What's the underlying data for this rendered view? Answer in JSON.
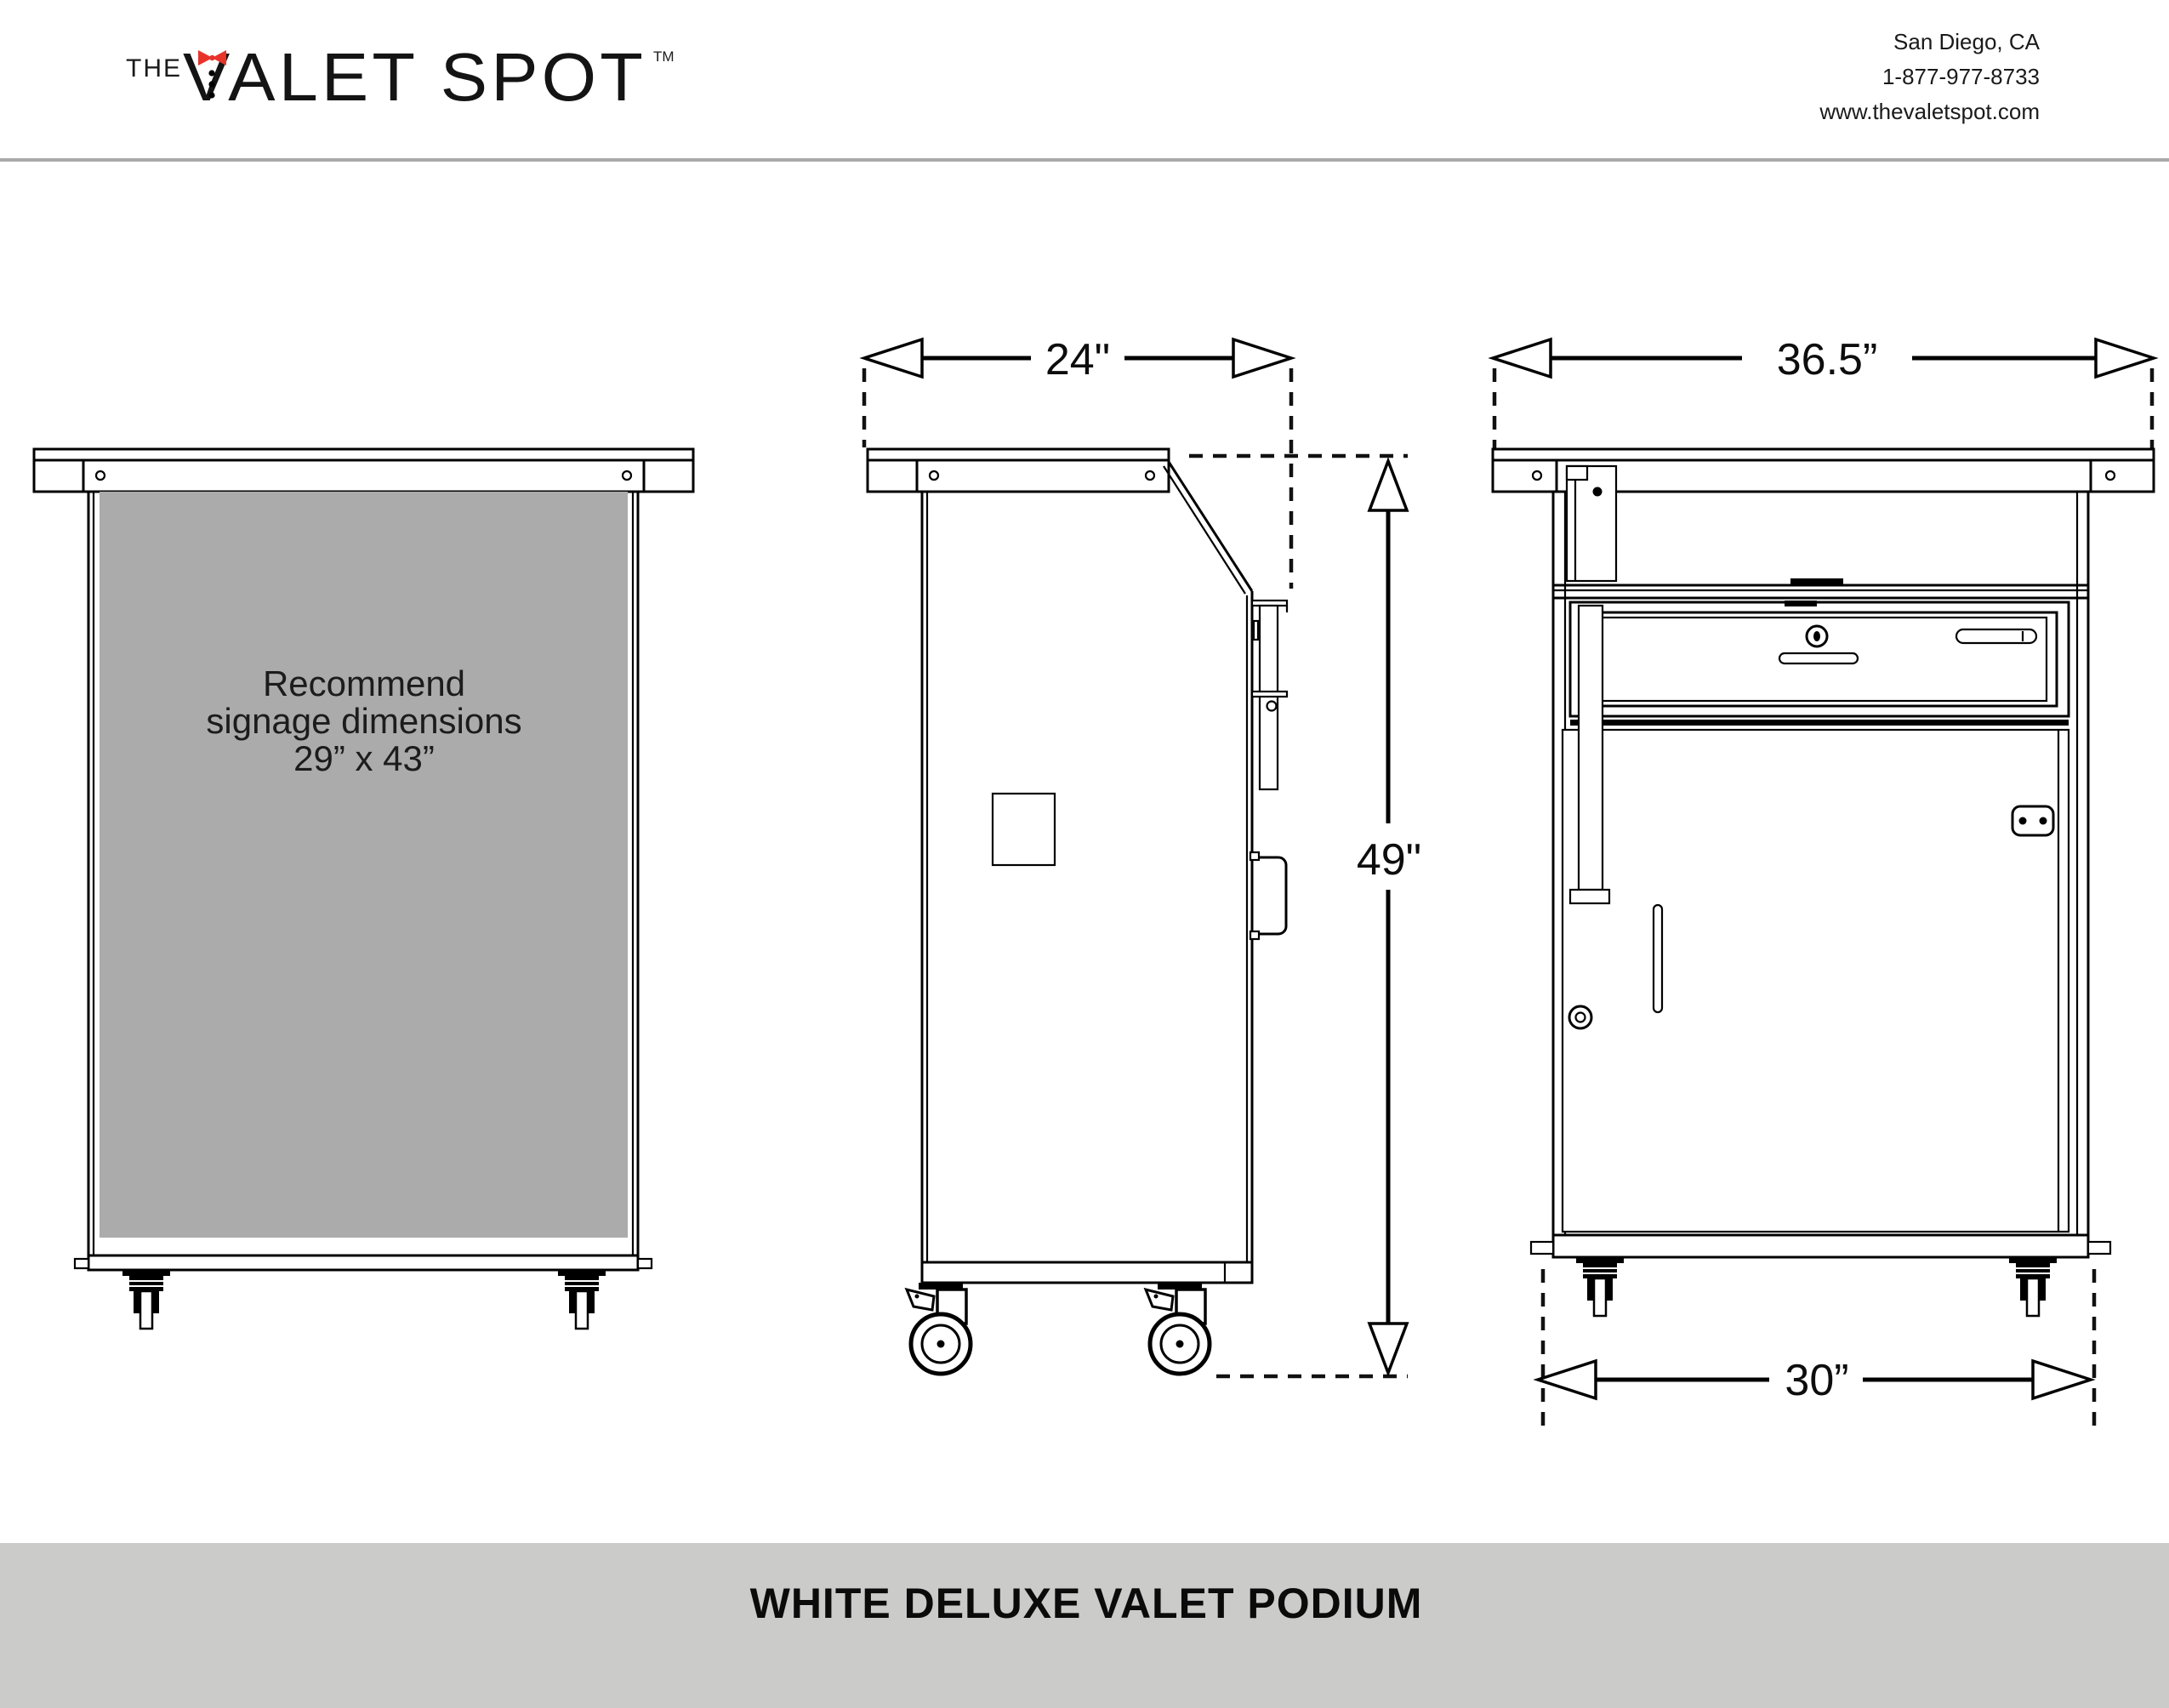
{
  "header": {
    "logo": {
      "prefix": "THE",
      "brand": "VALET SPOT",
      "trademark": "TM"
    },
    "contact": {
      "location": "San Diego, CA",
      "phone": "1-877-977-8733",
      "website": "www.thevaletspot.com"
    }
  },
  "drawings": {
    "front_signage_view": {
      "signage_line1": "Recommend",
      "signage_line2": "signage dimensions",
      "signage_line3": "29” x 43”"
    },
    "side_view": {
      "depth_label": "24\"",
      "height_label": "49\""
    },
    "front_view": {
      "top_width_label": "36.5”",
      "base_width_label": "30”"
    }
  },
  "footer": {
    "product_title": "WHITE DELUXE VALET PODIUM"
  },
  "colors": {
    "signage_gray": "#ababab",
    "footer_gray": "#cbcbca",
    "divider_gray": "#a9a9a9",
    "bowtie_red": "#e8332b",
    "ink": "#000000"
  }
}
